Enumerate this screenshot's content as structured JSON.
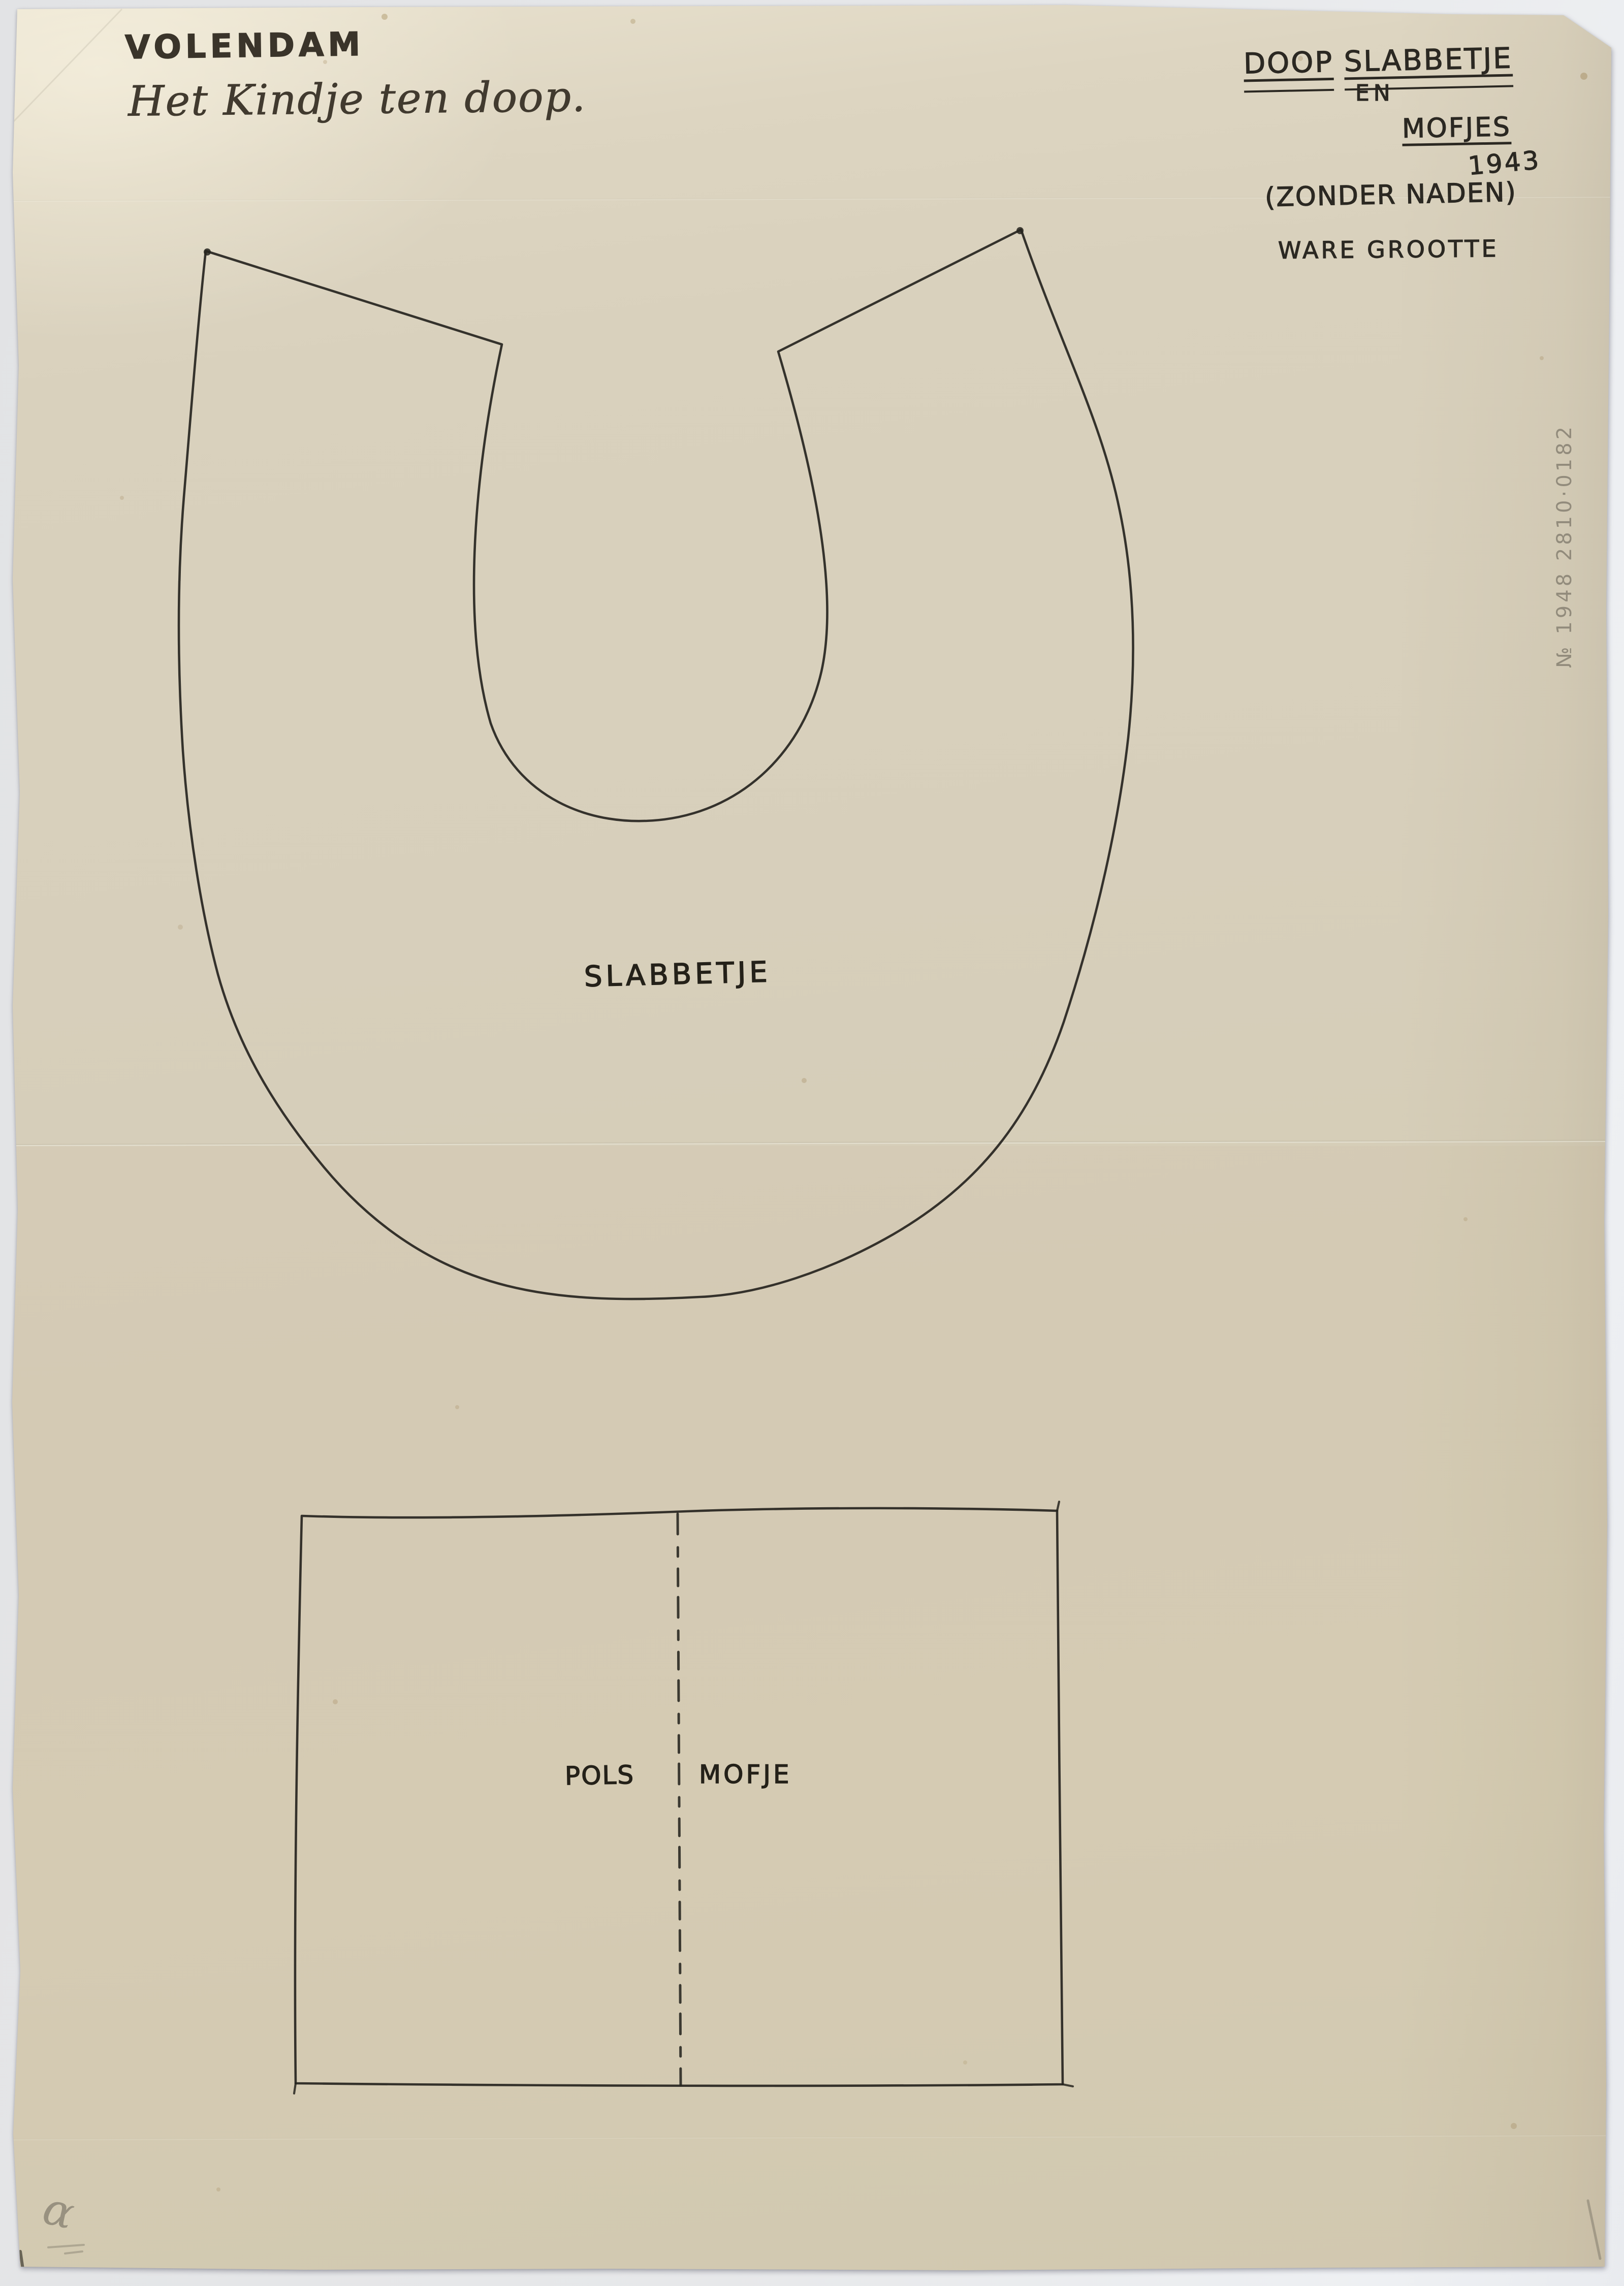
{
  "scan": {
    "header_left": {
      "title": "VOLENDAM",
      "subtitle": "Het Kindje ten doop."
    },
    "header_right": {
      "title_word1": "DOOP",
      "title_word2": "SLABBETJE",
      "conjunction": "EN",
      "title_word3": "MOFJES",
      "year": "1943",
      "note_seams": "(ZONDER NADEN)",
      "note_size": "WARE GROOTTE"
    },
    "bib": {
      "label": "SLABBETJE"
    },
    "muff": {
      "left_label": "POLS",
      "right_label": "MOFJE"
    },
    "annotations": {
      "pencil_inventory_number": "№ 1948 2810·0182",
      "pencil_corner_mark": "α"
    },
    "colors": {
      "paper": "#d7cfba",
      "paper_highlight": "#e9e2cf",
      "ink": "#2a2721",
      "pencil": "#8d887a",
      "scanner_background": "#e8e9ec"
    }
  }
}
